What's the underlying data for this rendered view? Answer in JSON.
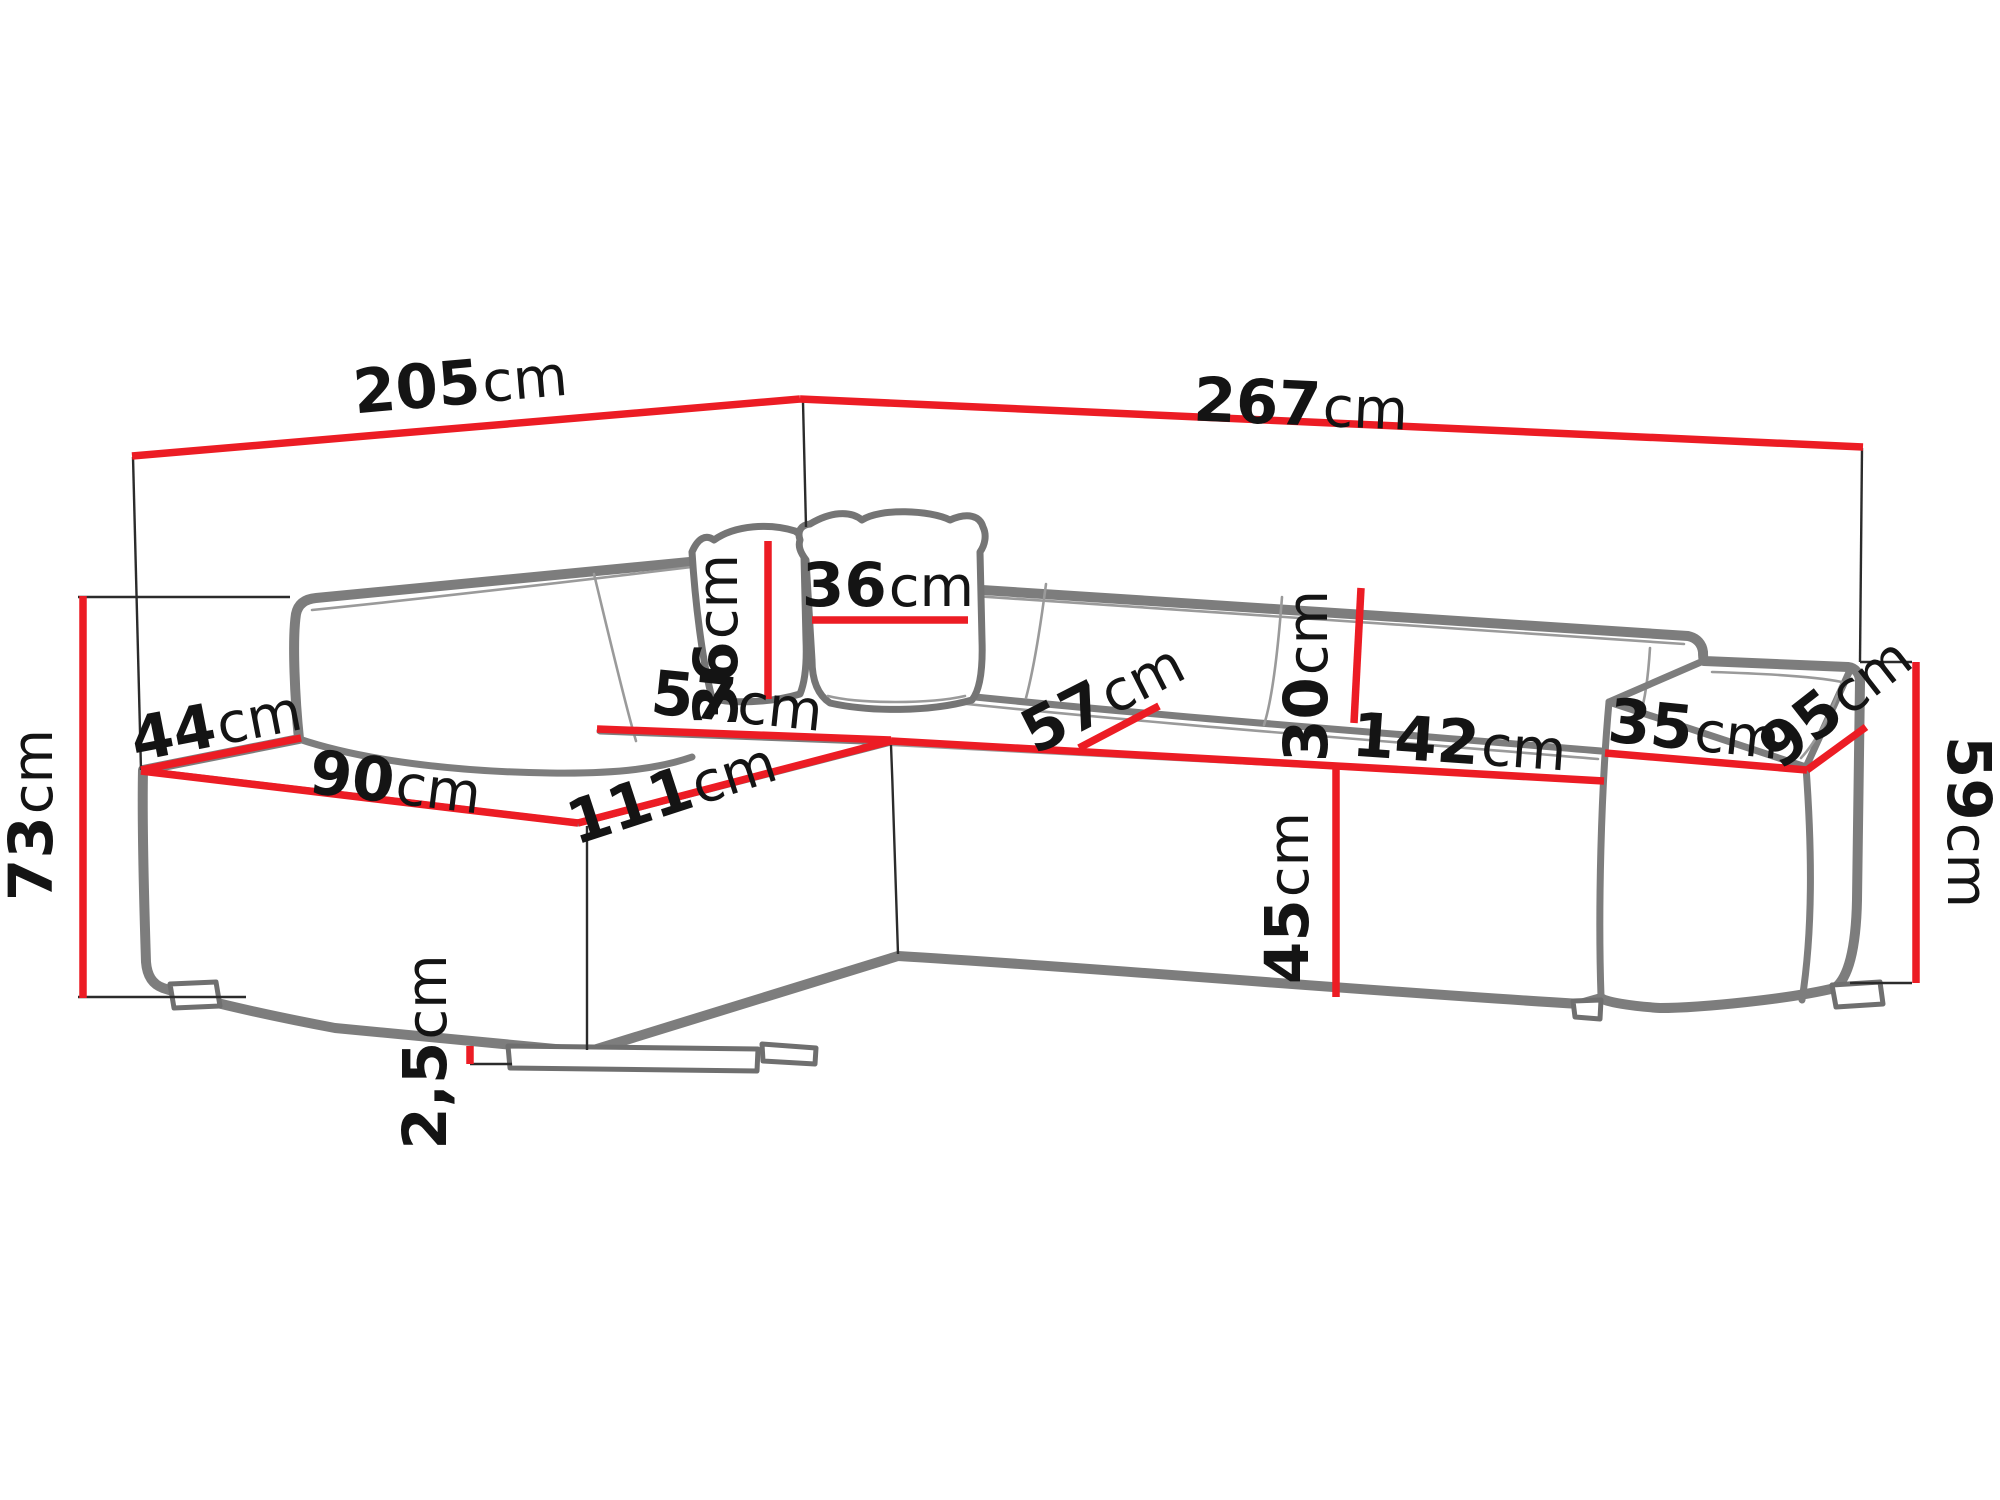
{
  "diagram": {
    "title": "corner-sofa-dimension-diagram",
    "background": "#ffffff",
    "accent_red": "#ec1c24",
    "outline_grey": "#7d7d7d",
    "helper_black": "#2b2b2b",
    "text_color": "#141414",
    "dimensions": [
      {
        "id": "back-width-left",
        "value": "205",
        "unit": "cm"
      },
      {
        "id": "back-width-right",
        "value": "267",
        "unit": "cm"
      },
      {
        "id": "overall-height",
        "value": "73",
        "unit": "cm"
      },
      {
        "id": "left-arm-depth",
        "value": "44",
        "unit": "cm"
      },
      {
        "id": "seat-depth-left",
        "value": "90",
        "unit": "cm"
      },
      {
        "id": "chaise-length",
        "value": "111",
        "unit": "cm"
      },
      {
        "id": "corner-seat-width",
        "value": "57",
        "unit": "cm"
      },
      {
        "id": "pillow-height",
        "value": "36",
        "unit": "cm"
      },
      {
        "id": "pillow-width",
        "value": "36",
        "unit": "cm"
      },
      {
        "id": "seat-depth-right",
        "value": "57",
        "unit": "cm"
      },
      {
        "id": "back-cushion-height",
        "value": "30",
        "unit": "cm"
      },
      {
        "id": "seat-width-right",
        "value": "142",
        "unit": "cm"
      },
      {
        "id": "seat-height",
        "value": "45",
        "unit": "cm"
      },
      {
        "id": "armrest-width",
        "value": "35",
        "unit": "cm"
      },
      {
        "id": "armrest-depth",
        "value": "95",
        "unit": "cm"
      },
      {
        "id": "armrest-height",
        "value": "59",
        "unit": "cm"
      },
      {
        "id": "leg-height",
        "value": "2,5",
        "unit": "cm"
      }
    ]
  }
}
